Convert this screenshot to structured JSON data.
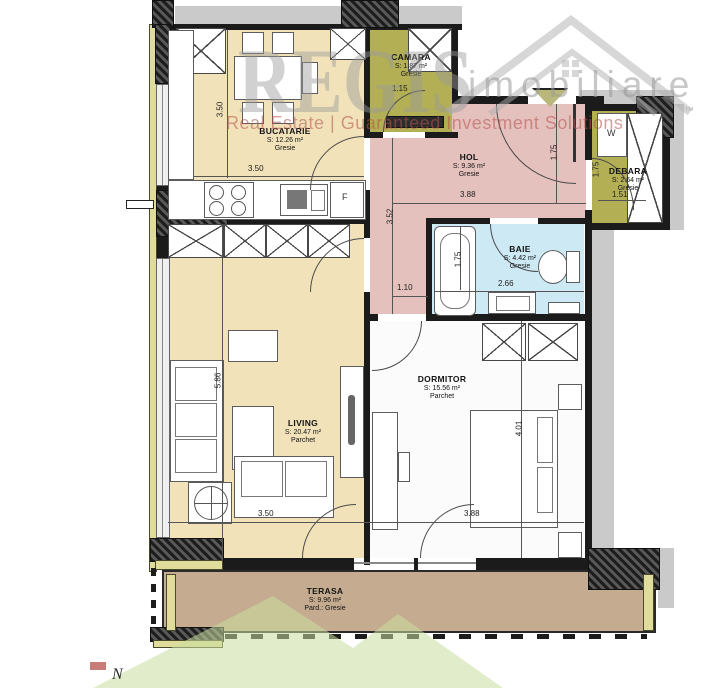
{
  "watermark": {
    "brand": "REGIS",
    "brand_suffix": "imobiliare",
    "tm": "™",
    "tagline": "Real Estate | Guaranteed Investment Solutions"
  },
  "compass": {
    "north": "N"
  },
  "rooms": [
    {
      "name": "BUCATARIE",
      "area": "S: 12.26 m²",
      "floor": "Gresie"
    },
    {
      "name": "CAMARA",
      "area": "S: 1.87 m²",
      "floor": "Gresie"
    },
    {
      "name": "HOL",
      "area": "S: 9.36 m²",
      "floor": "Gresie"
    },
    {
      "name": "DEBARA",
      "area": "S: 2.64 m²",
      "floor": "Gresie"
    },
    {
      "name": "BAIE",
      "area": "S: 4.42 m²",
      "floor": "Gresie"
    },
    {
      "name": "LIVING",
      "area": "S: 20.47 m²",
      "floor": "Parchet"
    },
    {
      "name": "DORMITOR",
      "area": "S: 15.56 m²",
      "floor": "Parchet"
    },
    {
      "name": "TERASA",
      "area": "S: 9.96 m²",
      "floor": "Pard.: Gresie"
    }
  ],
  "dims": {
    "kitchen_v": "3.50",
    "kitchen_h": "3.50",
    "camara_w": "1.15",
    "hol_w": "3.88",
    "hol_entry": "1.75",
    "hol_v": "3.52",
    "hol_pass": "1.10",
    "baie_v": "1.75",
    "baie_w": "2.66",
    "debara_v": "1.75",
    "debara_w": "1.51",
    "living_v": "5.86",
    "living_w": "3.50",
    "dorm_v": "4.01",
    "dorm_w": "3.88"
  },
  "appliances": {
    "fridge": "F",
    "wardrobe": "W"
  },
  "colors": {
    "kitchen_living_beige": "#F1E2BA",
    "hol_pink": "#E5C1BD",
    "baie_blue": "#CDE9F4",
    "camara_olive": "#B2AF55",
    "terasa_tan": "#C5AB90",
    "exterior_gray": "#CACACA",
    "logo_green": "#C8DF9E",
    "brand_gray": "#9B9B9B",
    "tagline_red": "#B5524E"
  }
}
